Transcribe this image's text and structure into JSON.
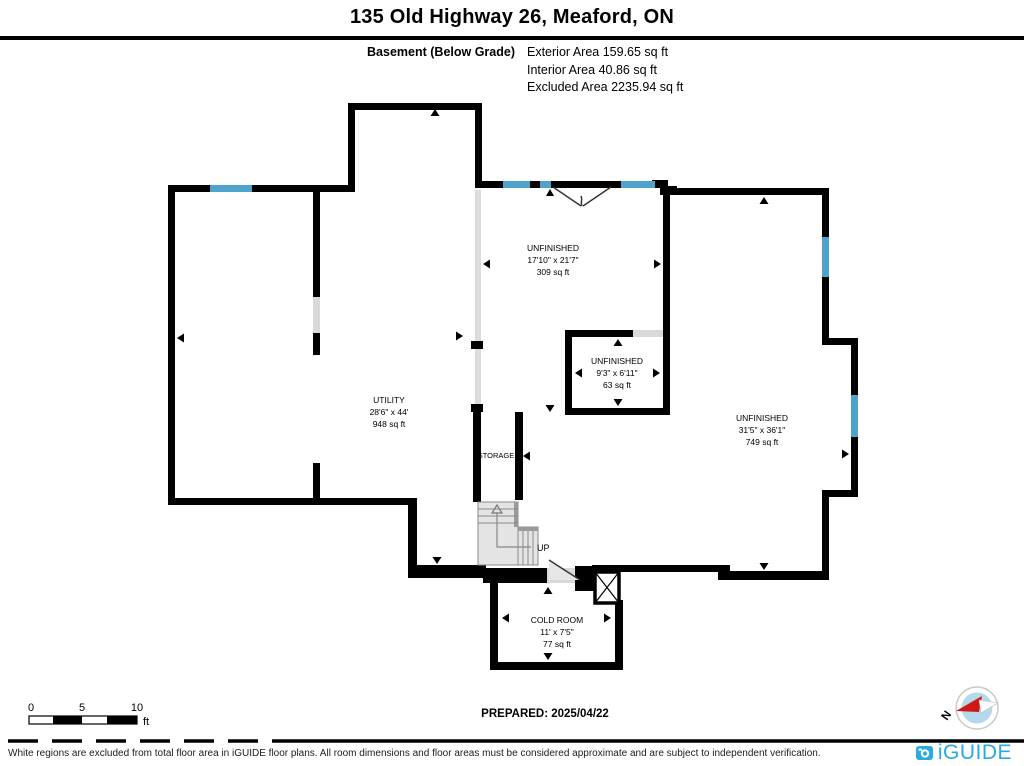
{
  "header": {
    "title": "135 Old Highway 26, Meaford, ON",
    "floor_label": "Basement (Below Grade)",
    "areas": [
      "Exterior Area 159.65 sq ft",
      "Interior Area 40.86 sq ft",
      "Excluded Area 2235.94 sq ft"
    ]
  },
  "plan": {
    "rooms": [
      {
        "name": "UNFINISHED",
        "dims": "17'10\" x 21'7\"",
        "area": "309 sq ft"
      },
      {
        "name": "UNFINISHED",
        "dims": "9'3\" x 6'11\"",
        "area": "63 sq ft"
      },
      {
        "name": "UNFINISHED",
        "dims": "31'5\" x 36'1\"",
        "area": "749 sq ft"
      },
      {
        "name": "UTILITY",
        "dims": "28'6\" x 44'",
        "area": "948 sq ft"
      },
      {
        "name": "COLD ROOM",
        "dims": "11' x 7'5\"",
        "area": "77 sq ft"
      }
    ],
    "storage_label": "STORAGE",
    "up_label": "UP",
    "compass_north": "N"
  },
  "scale_bar": {
    "ticks": [
      "0",
      "5",
      "10"
    ],
    "unit": "ft"
  },
  "prepared_label": "PREPARED: 2025/04/22",
  "footer": {
    "disclaimer": "White regions are excluded from total floor area in iGUIDE floor plans. All room dimensions and floor areas must be considered approximate and are subject to independent verification.",
    "brand": "iGUIDE"
  },
  "colors": {
    "wall": "#000000",
    "window": "#4da3cc",
    "opening": "#d9d9d9",
    "brand_blue": "#29abe2",
    "compass_red": "#d01717",
    "compass_fill": "#b5d8ea"
  }
}
